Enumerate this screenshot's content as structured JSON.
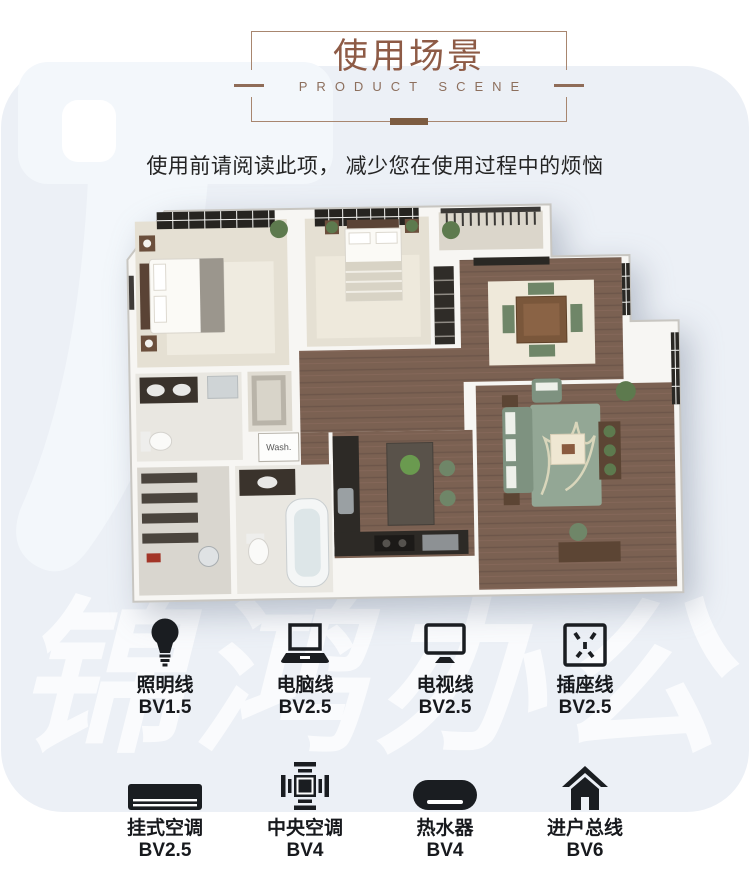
{
  "header": {
    "title": "使用场景",
    "subtitle": "PRODUCT SCENE"
  },
  "intro": {
    "text": "使用前请阅读此项， 减少您在使用过程中的烦恼"
  },
  "watermark": {
    "text": "锦鸿办公"
  },
  "floor_plan": {
    "wash_label": "Wash."
  },
  "specs": [
    {
      "icon": "bulb-icon",
      "label": "照明线",
      "value": "BV1.5"
    },
    {
      "icon": "laptop-icon",
      "label": "电脑线",
      "value": "BV2.5"
    },
    {
      "icon": "tv-icon",
      "label": "电视线",
      "value": "BV2.5"
    },
    {
      "icon": "socket-icon",
      "label": "插座线",
      "value": "BV2.5"
    },
    {
      "icon": "wall-ac-icon",
      "label": "挂式空调",
      "value": "BV2.5"
    },
    {
      "icon": "central-ac-icon",
      "label": "中央空调",
      "value": "BV4"
    },
    {
      "icon": "water-heater-icon",
      "label": "热水器",
      "value": "BV4"
    },
    {
      "icon": "house-icon",
      "label": "进户总线",
      "value": "BV6"
    }
  ],
  "colors": {
    "title_brown": "#8e5b46",
    "accent_brown": "#7d5c41",
    "panel_blue": "#ecf0f6",
    "icon_black": "#1a1d21",
    "wood_floor": "#7b6152",
    "sofa_green": "#7e9280"
  }
}
